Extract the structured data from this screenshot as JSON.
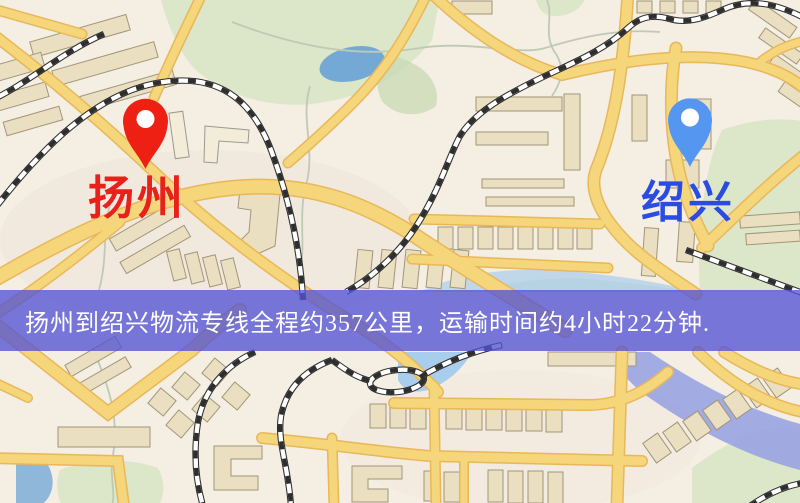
{
  "markers": {
    "origin": {
      "label": "扬州",
      "pin": "red-map-pin",
      "pin_color": "#ee2014",
      "label_color": "#e8211a"
    },
    "destination": {
      "label": "绍兴",
      "pin": "blue-map-pin",
      "pin_color": "#5596f0",
      "label_color": "#2b4ce0"
    }
  },
  "banner": {
    "text": "扬州到绍兴物流专线全程约357公里，运输时间约4小时22分钟.",
    "distance_km": "357",
    "duration": "4小时22分钟"
  },
  "colors": {
    "map_bg": "#f4eee3",
    "road_fill": "#f6d67b",
    "road_casing": "#e8b75a",
    "building_fill": "#eadfc0",
    "building_stroke": "#a2967a",
    "building_light": "#f3ecd9",
    "park": "#dce6c8",
    "park_dark": "#c9dab4",
    "water": "#74a9d6",
    "water_light": "#a9cdec",
    "river": "#9aa3e2",
    "railway": "#2e2e2e",
    "trail": "#bfcab6",
    "origin_pin": "#ee2014",
    "origin_label": "#e8211a",
    "destination_pin": "#5596f0",
    "destination_label": "#2b4ce0",
    "banner_bg": "#5353d4",
    "banner_text": "#ffffff"
  }
}
